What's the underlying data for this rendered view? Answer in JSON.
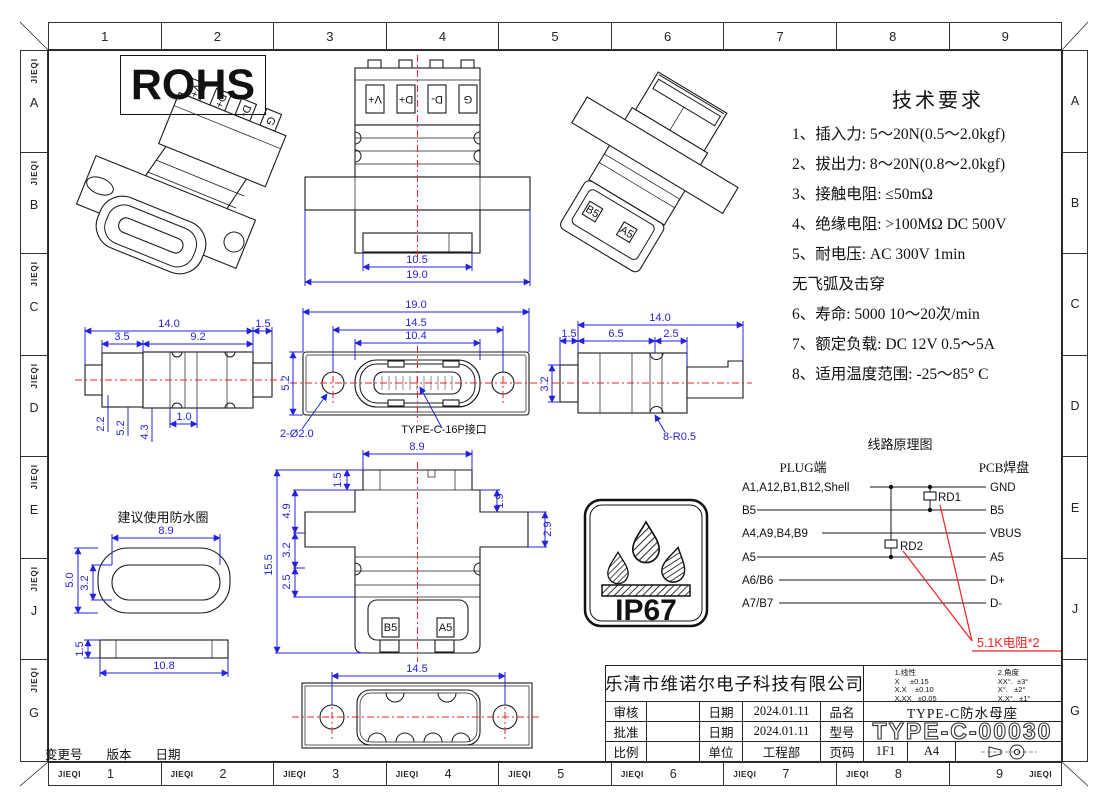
{
  "sheet": {
    "brand": "JIEQI",
    "cols": [
      "1",
      "2",
      "3",
      "4",
      "5",
      "6",
      "7",
      "8",
      "9"
    ],
    "rows": [
      "A",
      "B",
      "C",
      "D",
      "E",
      "J",
      "G"
    ],
    "rohs": "ROHS",
    "revision": {
      "change": "变更号",
      "version": "版本",
      "date": "日期"
    }
  },
  "tech": {
    "title": "技术要求",
    "lines": [
      "1、插入力: 5～20N(0.5～2.0kgf)",
      "2、拔出力: 8～20N(0.8～2.0kgf)",
      "3、接触电阻: ≤50mΩ",
      "4、绝缘电阻: >100MΩ  DC  500V",
      "5、耐电压: AC  300V  1min",
      "无飞弧及击穿",
      "6、寿命:  5000 10～20次/min",
      "7、额定负载: DC  12V  0.5～5A",
      "8、适用温度范围: -25～85° C"
    ]
  },
  "circuit": {
    "title": "线路原理图",
    "plug": "PLUG端",
    "pcb": "PCB焊盘",
    "rows": [
      {
        "left": "A1,A12,B1,B12,Shell",
        "right": "GND"
      },
      {
        "left": "B5",
        "right": "B5"
      },
      {
        "left": "A4,A9,B4,B9",
        "right": "VBUS"
      },
      {
        "left": "A5",
        "right": "A5"
      },
      {
        "left": "A6/B6",
        "right": "D+"
      },
      {
        "left": "A7/B7",
        "right": "D-"
      }
    ],
    "rd1": "RD1",
    "rd2": "RD2",
    "note": "5.1K电阻*2"
  },
  "views": {
    "top": {
      "terminals": [
        "V+",
        "D+",
        "D-",
        "G"
      ],
      "dims": {
        "inner": "10.5",
        "outer": "19.0"
      }
    },
    "side_left": {
      "dims": {
        "total": "14.0",
        "a": "3.5",
        "b": "9.2",
        "c": "1.5",
        "h1": "2.2",
        "h2": "5.2",
        "h3": "4.3",
        "groove": "1.0"
      }
    },
    "front": {
      "dims": {
        "w": "19.0",
        "holes": "14.5",
        "port": "10.4",
        "h": "5.2"
      },
      "hole_note": "2-Ø2.0",
      "port_note": "TYPE-C-16P接口"
    },
    "side_right": {
      "dims": {
        "total": "14.0",
        "a": "1.5",
        "b": "6.5",
        "c": "2.5",
        "h": "3.2"
      },
      "radius_note": "8-R0.5"
    },
    "back": {
      "dims": {
        "w": "8.9",
        "a": "1.5",
        "b": "4.9",
        "c": "3.2",
        "d": "2.5",
        "h": "15.5",
        "e": "1.9",
        "f": "2.9"
      },
      "terminals": [
        "B5",
        "A5"
      ]
    },
    "bottom": {
      "dims": {
        "holes": "14.5"
      }
    },
    "ring": {
      "title": "建议使用防水圈",
      "dims": {
        "w": "8.9",
        "h": "5.0",
        "ih": "3.2",
        "t": "1.5",
        "len": "10.8"
      }
    }
  },
  "ip67": {
    "label": "IP67"
  },
  "title_block": {
    "company": "乐清市维诺尔电子科技有限公司",
    "tol": {
      "linear_title": "1.线性",
      "linear": [
        "X     ±0.15",
        "X.X    ±0.10",
        "X.XX   ±0.05"
      ],
      "angle_title": "2.角度",
      "angle": [
        "XX°.  ±3°",
        "X°.   ±2°",
        "X.X°.  ±1°"
      ]
    },
    "review_label": "审核",
    "date_label_1": "日期",
    "date_1": "2024.01.11",
    "pn_label": "品名",
    "pn": "TYPE-C防水母座",
    "approve_label": "批准",
    "date_label_2": "日期",
    "date_2": "2024.01.11",
    "model_label": "型号",
    "model": "TYPE-C-00030",
    "scale_label": "比例",
    "unit_label": "单位",
    "unit": "工程部",
    "page_label": "页码",
    "page": "1F1",
    "size": "A4"
  }
}
